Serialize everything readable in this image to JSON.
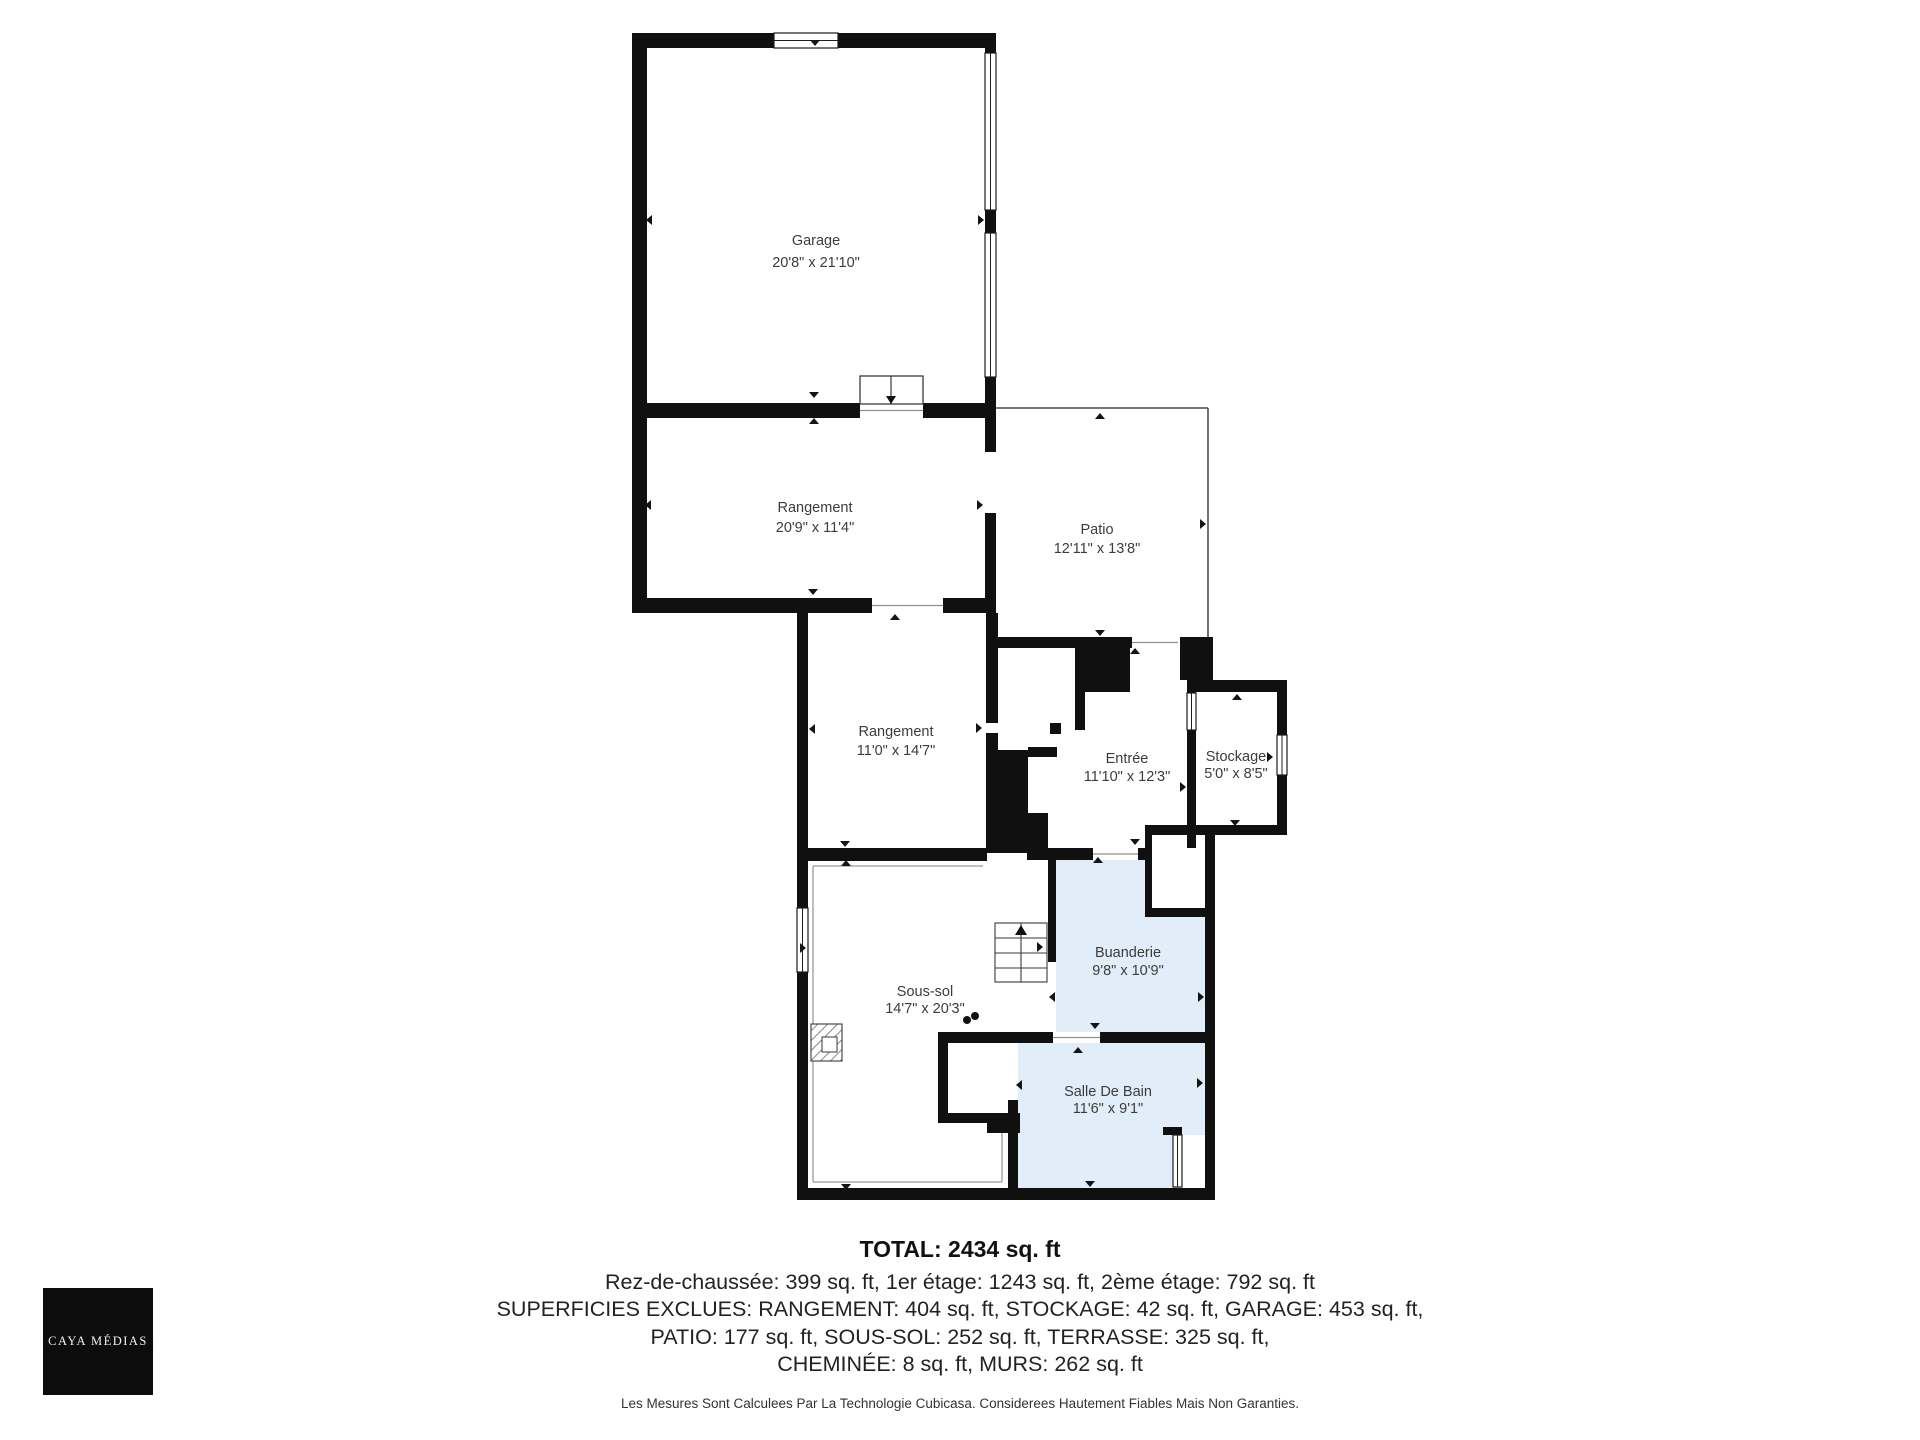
{
  "page": {
    "background": "#ffffff"
  },
  "colors": {
    "wall": "#101010",
    "room_label": "#3c3c3c",
    "wet_room_fill": "#e1edf8",
    "window_stroke": "#1c1c1c",
    "opening_line": "#8f8f8f",
    "patio_outline": "#4d4d4d",
    "inset_outline": "#9b9b9b",
    "symbol_stroke": "#3a3a3a",
    "logo_bg": "#0c0c0c",
    "logo_text": "#f2f2f2"
  },
  "summary": {
    "title": "TOTAL: 2434 sq. ft",
    "line1": "Rez-de-chaussée: 399 sq. ft, 1er étage: 1243 sq. ft, 2ème étage: 792 sq. ft",
    "line2": "SUPERFICIES EXCLUES: RANGEMENT: 404 sq. ft, STOCKAGE: 42 sq. ft, GARAGE: 453 sq. ft,",
    "line3": "PATIO: 177 sq. ft, SOUS-SOL: 252 sq. ft, TERRASSE: 325 sq. ft,",
    "line4": "CHEMINÉE: 8 sq. ft, MURS: 262 sq. ft",
    "disclaimer": "Les Mesures Sont Calculees Par La Technologie Cubicasa. Considerees Hautement Fiables Mais Non Garanties."
  },
  "logo": {
    "text": "| CAYA MÉDIAS |"
  },
  "rooms": [
    {
      "id": "garage",
      "name": "Garage",
      "dims": "20'8\" x 21'10\"",
      "cx": 816,
      "name_y": 245,
      "dims_y": 267,
      "wet": false
    },
    {
      "id": "rangement-haut",
      "name": "Rangement",
      "dims": "20'9\" x 11'4\"",
      "cx": 815,
      "name_y": 512,
      "dims_y": 532,
      "wet": false
    },
    {
      "id": "patio",
      "name": "Patio",
      "dims": "12'11\" x 13'8\"",
      "cx": 1097,
      "name_y": 534,
      "dims_y": 553,
      "wet": false
    },
    {
      "id": "rangement-bas",
      "name": "Rangement",
      "dims": "11'0\" x 14'7\"",
      "cx": 896,
      "name_y": 736,
      "dims_y": 755,
      "wet": false
    },
    {
      "id": "entree",
      "name": "Entrée",
      "dims": "11'10\" x 12'3\"",
      "cx": 1127,
      "name_y": 763,
      "dims_y": 781,
      "wet": false
    },
    {
      "id": "stockage",
      "name": "Stockage",
      "dims": "5'0\" x 8'5\"",
      "cx": 1236,
      "name_y": 761,
      "dims_y": 778,
      "wet": false
    },
    {
      "id": "sous-sol",
      "name": "Sous-sol",
      "dims": "14'7\" x 20'3\"",
      "cx": 925,
      "name_y": 996,
      "dims_y": 1013,
      "wet": false
    },
    {
      "id": "buanderie",
      "name": "Buanderie",
      "dims": "9'8\" x 10'9\"",
      "cx": 1128,
      "name_y": 957,
      "dims_y": 975,
      "wet": true
    },
    {
      "id": "salle-de-bain",
      "name": "Salle De Bain",
      "dims": "11'6\" x 9'1\"",
      "cx": 1108,
      "name_y": 1096,
      "dims_y": 1113,
      "wet": true
    }
  ],
  "plan": {
    "wet_areas": [
      [
        1056,
        860,
        149,
        172
      ],
      [
        1018,
        1040,
        187,
        148
      ]
    ],
    "white_patches": [
      [
        1145,
        835,
        60,
        82
      ],
      [
        1182,
        1135,
        23,
        53
      ]
    ],
    "walls": [
      [
        632,
        33,
        364,
        15
      ],
      [
        632,
        33,
        15,
        580
      ],
      [
        985,
        33,
        11,
        20
      ],
      [
        985,
        210,
        11,
        23
      ],
      [
        985,
        377,
        11,
        75
      ],
      [
        985,
        513,
        11,
        100
      ],
      [
        632,
        403,
        228,
        15
      ],
      [
        923,
        403,
        73,
        15
      ],
      [
        632,
        598,
        240,
        15
      ],
      [
        943,
        598,
        53,
        15
      ],
      [
        986,
        613,
        12,
        110
      ],
      [
        986,
        733,
        12,
        17
      ],
      [
        986,
        750,
        42,
        103
      ],
      [
        1028,
        813,
        20,
        40
      ],
      [
        1028,
        747,
        29,
        10
      ],
      [
        986,
        637,
        146,
        11
      ],
      [
        1180,
        637,
        33,
        43
      ],
      [
        1075,
        640,
        55,
        52
      ],
      [
        1075,
        692,
        10,
        38
      ],
      [
        1050,
        723,
        11,
        11
      ],
      [
        1187,
        680,
        9,
        13
      ],
      [
        1187,
        730,
        9,
        118
      ],
      [
        1196,
        680,
        91,
        12
      ],
      [
        1277,
        680,
        10,
        55
      ],
      [
        1277,
        775,
        10,
        60
      ],
      [
        1145,
        825,
        140,
        10
      ],
      [
        1145,
        835,
        7,
        73
      ],
      [
        1145,
        908,
        60,
        9
      ],
      [
        1205,
        835,
        10,
        365
      ],
      [
        1027,
        848,
        66,
        12
      ],
      [
        1138,
        848,
        14,
        12
      ],
      [
        797,
        848,
        190,
        13
      ],
      [
        1048,
        860,
        8,
        102
      ],
      [
        938,
        1032,
        115,
        11
      ],
      [
        1100,
        1032,
        105,
        11
      ],
      [
        938,
        1032,
        10,
        91
      ],
      [
        938,
        1113,
        82,
        10
      ],
      [
        1008,
        1100,
        10,
        88
      ],
      [
        987,
        1118,
        33,
        15
      ],
      [
        797,
        1188,
        418,
        12
      ],
      [
        797,
        602,
        11,
        306
      ],
      [
        797,
        972,
        11,
        228
      ],
      [
        1163,
        1127,
        19,
        8
      ]
    ],
    "windows": [
      [
        774,
        33,
        64,
        15,
        "h"
      ],
      [
        985,
        53,
        11,
        157,
        "v"
      ],
      [
        985,
        233,
        11,
        144,
        "v"
      ],
      [
        1187,
        693,
        9,
        37,
        "v"
      ],
      [
        1277,
        735,
        10,
        40,
        "v"
      ],
      [
        797,
        908,
        11,
        64,
        "v"
      ],
      [
        1173,
        1135,
        9,
        52,
        "v"
      ]
    ],
    "openings": [
      [
        860,
        403,
        63,
        15,
        1
      ],
      [
        872,
        598,
        71,
        15,
        1
      ],
      [
        985,
        452,
        11,
        61,
        0
      ],
      [
        1132,
        637,
        46,
        11,
        1
      ],
      [
        1093,
        848,
        45,
        12,
        1
      ],
      [
        1053,
        1032,
        47,
        11,
        1
      ],
      [
        1008,
        1043,
        10,
        57,
        0
      ],
      [
        986,
        723,
        12,
        10,
        0
      ]
    ],
    "patio_lines": [
      [
        996,
        408,
        1208,
        408
      ],
      [
        1208,
        408,
        1208,
        637
      ]
    ],
    "inset_lines": [
      [
        813,
        866,
        983,
        866
      ],
      [
        813,
        866,
        813,
        1182
      ],
      [
        813,
        1182,
        1002,
        1182
      ],
      [
        1002,
        1129,
        1002,
        1182
      ]
    ],
    "ticks": [
      [
        815,
        46,
        "down"
      ],
      [
        646,
        220,
        "left"
      ],
      [
        984,
        220,
        "right"
      ],
      [
        814,
        398,
        "down"
      ],
      [
        814,
        418,
        "up"
      ],
      [
        645,
        505,
        "left"
      ],
      [
        983,
        505,
        "right"
      ],
      [
        813,
        595,
        "down"
      ],
      [
        895,
        614,
        "up"
      ],
      [
        1100,
        413,
        "up"
      ],
      [
        1206,
        524,
        "right"
      ],
      [
        1100,
        636,
        "down"
      ],
      [
        1135,
        648,
        "up"
      ],
      [
        809,
        729,
        "left"
      ],
      [
        982,
        728,
        "right"
      ],
      [
        1186,
        787,
        "right"
      ],
      [
        1237,
        694,
        "up"
      ],
      [
        1235,
        826,
        "down"
      ],
      [
        1273,
        757,
        "right"
      ],
      [
        1135,
        845,
        "down"
      ],
      [
        1098,
        857,
        "up"
      ],
      [
        845,
        847,
        "down"
      ],
      [
        846,
        860,
        "up"
      ],
      [
        806,
        948,
        "right"
      ],
      [
        1043,
        947,
        "right"
      ],
      [
        1049,
        997,
        "left"
      ],
      [
        1204,
        997,
        "right"
      ],
      [
        1095,
        1029,
        "down"
      ],
      [
        1078,
        1047,
        "up"
      ],
      [
        1016,
        1085,
        "left"
      ],
      [
        1203,
        1083,
        "right"
      ],
      [
        1090,
        1187,
        "down"
      ],
      [
        846,
        1190,
        "down"
      ]
    ],
    "stairs": {
      "x": 995,
      "y": 923,
      "w": 52,
      "h": 59,
      "treads": [
        938,
        953,
        968
      ],
      "center_x": 1021,
      "arrow": "up"
    },
    "landing": {
      "x": 860,
      "y": 376,
      "w": 63,
      "h": 28,
      "divider_x": 891,
      "arrow": "down"
    },
    "chimney": {
      "x": 811,
      "y": 1024,
      "w": 31,
      "h": 37,
      "inner": [
        822,
        1037,
        15,
        15
      ]
    },
    "dots": [
      [
        967,
        1020,
        4
      ],
      [
        975,
        1016,
        4
      ]
    ]
  }
}
